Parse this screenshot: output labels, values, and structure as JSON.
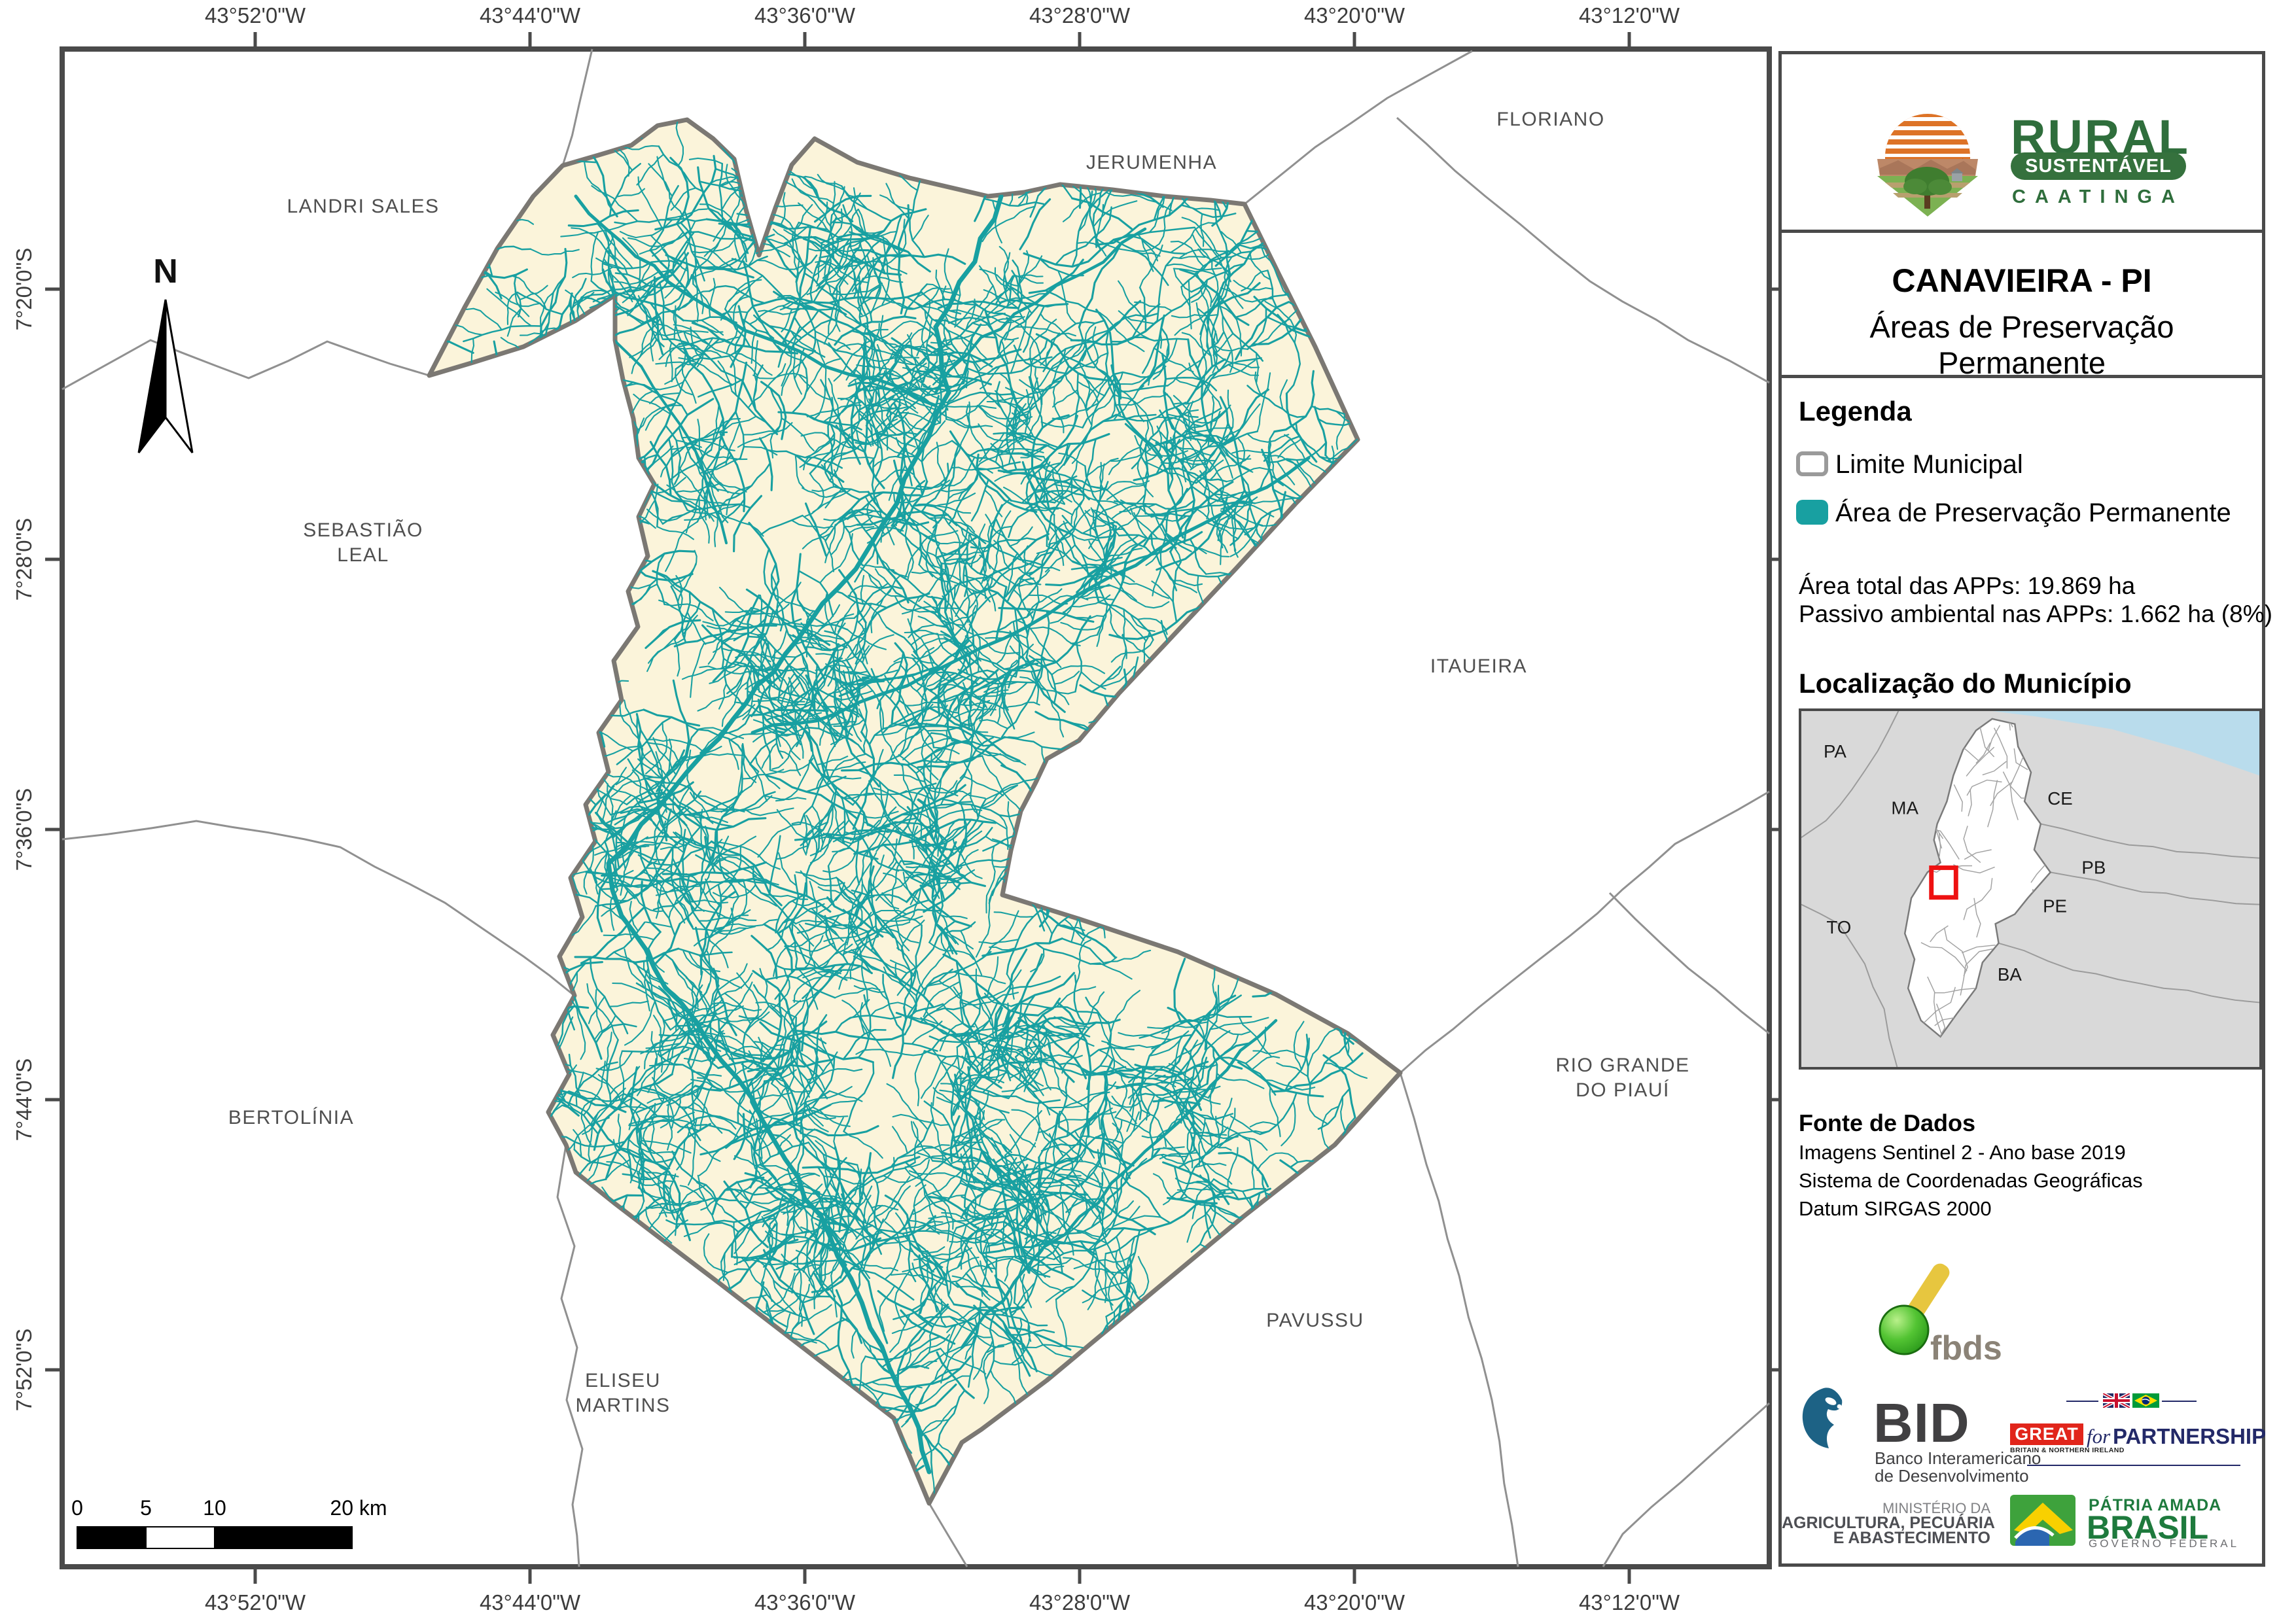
{
  "map": {
    "north_label": "N",
    "lon_labels": [
      "43°52'0\"W",
      "43°44'0\"W",
      "43°36'0\"W",
      "43°28'0\"W",
      "43°20'0\"W",
      "43°12'0\"W"
    ],
    "lat_labels": [
      "7°20'0\"S",
      "7°28'0\"S",
      "7°36'0\"S",
      "7°44'0\"S",
      "7°52'0\"S"
    ],
    "neighbor_labels": [
      "LANDRI SALES",
      "JERUMENHA",
      "FLORIANO",
      "SEBASTIÃO\nLEAL",
      "ITAUEIRA",
      "BERTOLÍNIA",
      "RIO GRANDE\nDO PIAUÍ",
      "ELISEU\nMARTINS",
      "PAVUSSU"
    ],
    "scalebar_labels": [
      "0",
      "5",
      "10",
      "20 km"
    ],
    "colors": {
      "app": "#18a0a1",
      "municipality_fill": "#fbf4da",
      "municipality_border": "#7b7873",
      "neighbor_boundary": "#909090",
      "frame": "#4a4a4a"
    }
  },
  "sidebar": {
    "logo": {
      "title": "RURAL",
      "subtitle": "SUSTENTÁVEL",
      "tagline": "CAATINGA"
    },
    "header": {
      "title": "CANAVIEIRA - PI",
      "subtitle": "Áreas de Preservação Permanente"
    },
    "legend": {
      "heading": "Legenda",
      "items": [
        {
          "label": "Limite Municipal",
          "swatch": "outline",
          "color": "#ffffff",
          "border": "#9a9a9a"
        },
        {
          "label": "Área de Preservação Permanente",
          "swatch": "fill",
          "color": "#18a0a1"
        }
      ],
      "stats": [
        "Área total das APPs: 19.869 ha",
        "Passivo ambiental nas APPs: 1.662 ha (8%)"
      ]
    },
    "location": {
      "heading": "Localização do Município",
      "state_labels": [
        "PA",
        "MA",
        "CE",
        "PB",
        "PE",
        "BA",
        "TO"
      ]
    },
    "source": {
      "heading": "Fonte de Dados",
      "lines": [
        "Imagens Sentinel 2 - Ano base 2019",
        "Sistema de Coordenadas Geográficas",
        "Datum SIRGAS 2000"
      ]
    },
    "partners": {
      "fbds": "fbds",
      "bid": {
        "name": "BID",
        "tagline": [
          "Banco Interamericano",
          "de Desenvolvimento"
        ]
      },
      "great": {
        "box": "GREAT",
        "box_sub": "BRITAIN & NORTHERN IRELAND",
        "middle": "for",
        "right": "PARTNERSHIP"
      },
      "ministry": [
        "MINISTÉRIO DA",
        "AGRICULTURA, PECUÁRIA",
        "E ABASTECIMENTO"
      ],
      "gov": {
        "line1": "PÁTRIA AMADA",
        "line2": "BRASIL",
        "line3": "GOVERNO FEDERAL"
      }
    }
  }
}
